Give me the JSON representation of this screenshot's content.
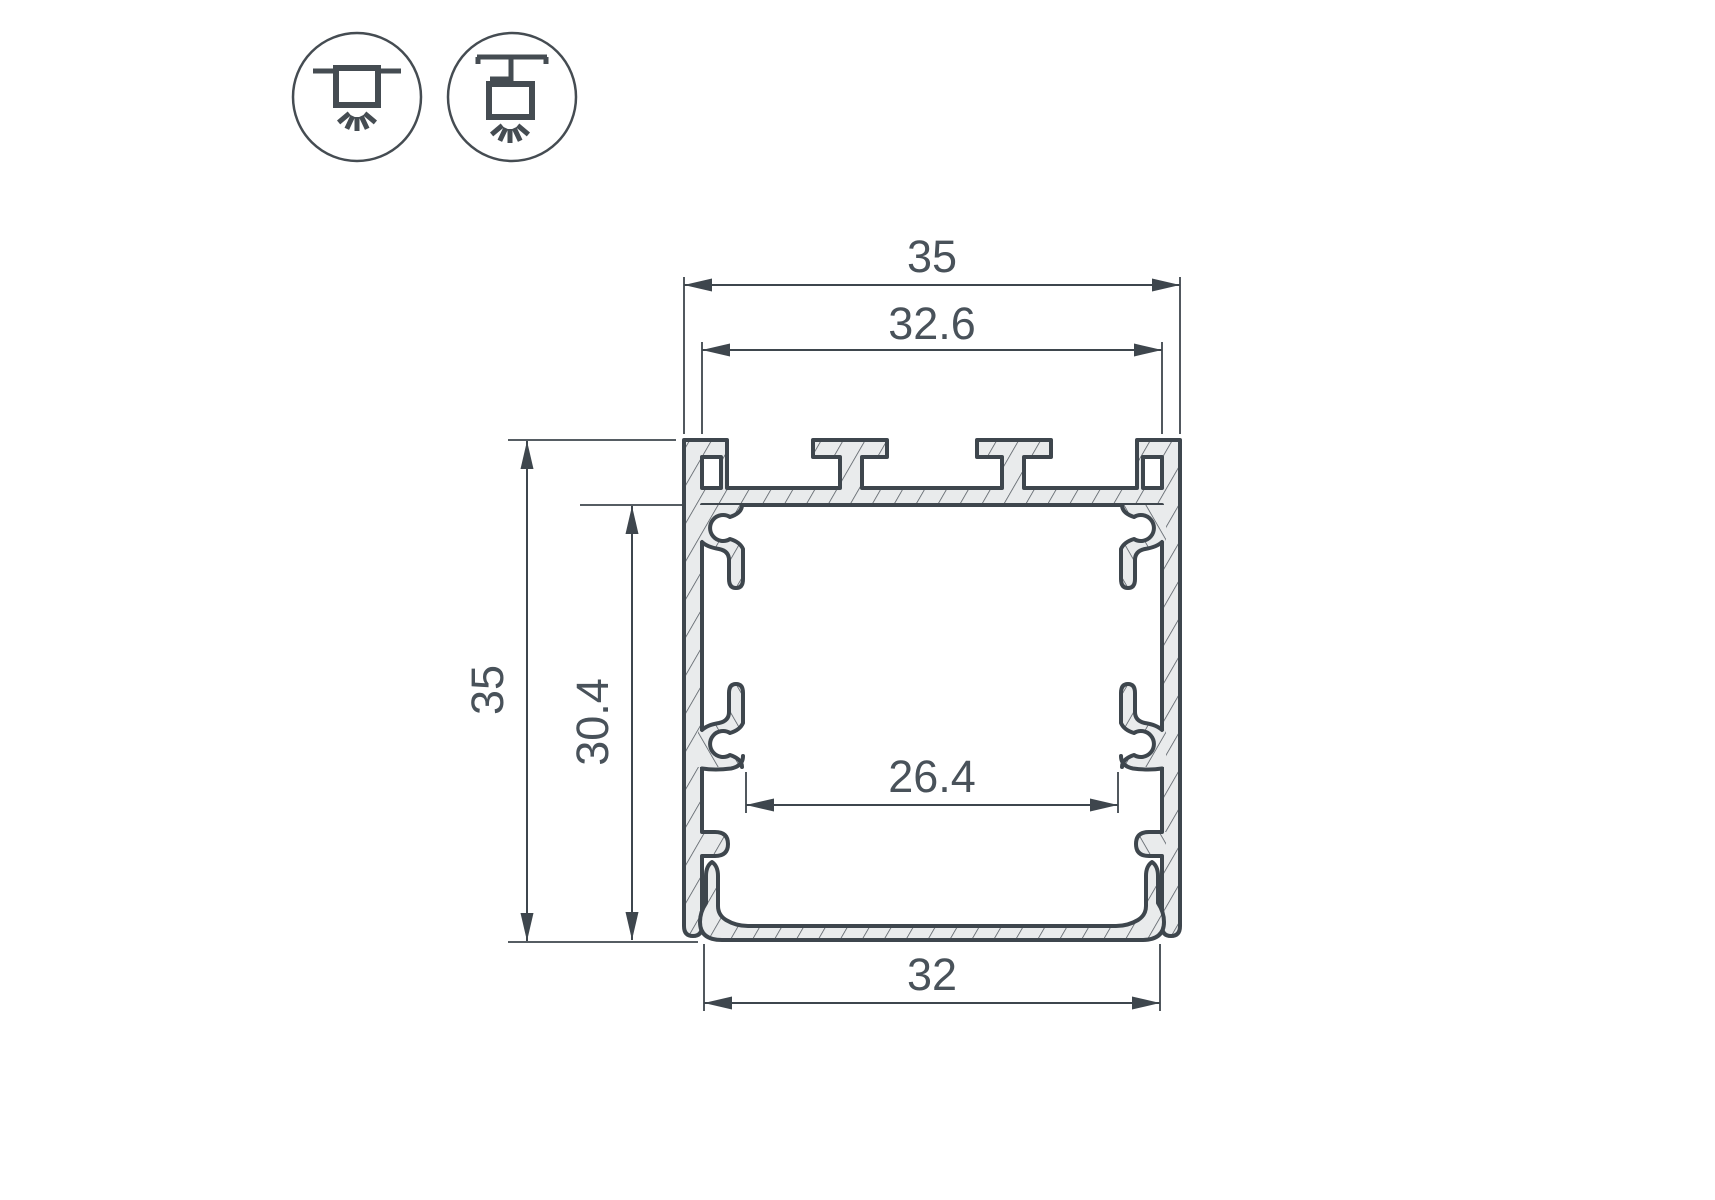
{
  "title": "Aluminium LED profile cross-section dimensional drawing",
  "icons": [
    {
      "name": "recessed-mount"
    },
    {
      "name": "pendant-mount"
    }
  ],
  "dims": {
    "outer_width": "35",
    "top_inner_width": "32.6",
    "outer_height": "35",
    "inner_height": "30.4",
    "inner_width": "26.4",
    "bottom_width": "32"
  },
  "colors": {
    "line": "#3e464d",
    "profile_fill": "#e9ebec",
    "hatch_line": "#4d545b",
    "text": "#49525a",
    "background": "#ffffff"
  }
}
